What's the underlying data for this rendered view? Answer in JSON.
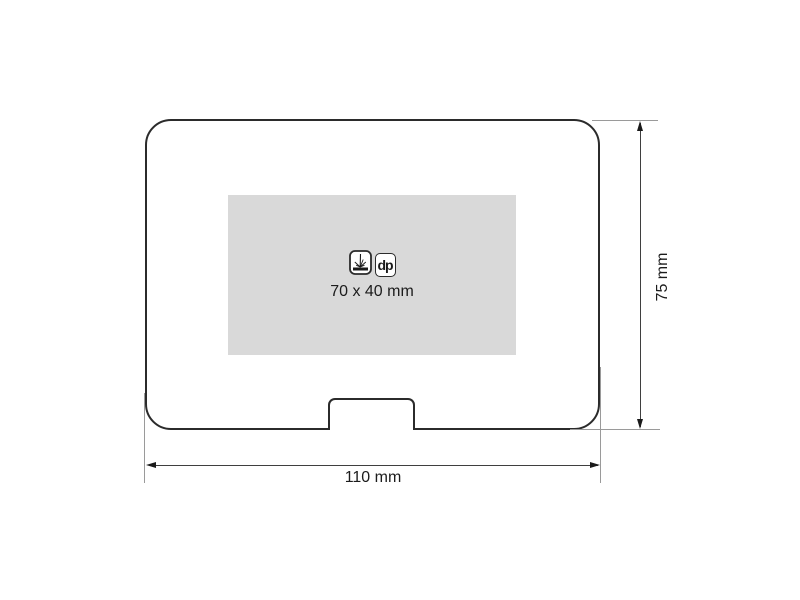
{
  "figure": {
    "type": "product-print-area-diagram",
    "print_area": {
      "size_label": "70 x 40 mm",
      "fill_color": "#d9d9d9",
      "methods": [
        {
          "icon": "laser-engraving-icon",
          "label": ""
        },
        {
          "icon": "digital-print-icon",
          "label": "dp"
        }
      ]
    },
    "dimensions": {
      "width": {
        "label": "110 mm"
      },
      "height": {
        "label": "75 mm"
      }
    },
    "colors": {
      "outline": "#2b2b2b",
      "dimension_line": "#3f3f3f",
      "extension_line": "#9a9a9a",
      "print_area_fill": "#d9d9d9",
      "text": "#1c1c1c",
      "background": "#ffffff"
    }
  }
}
